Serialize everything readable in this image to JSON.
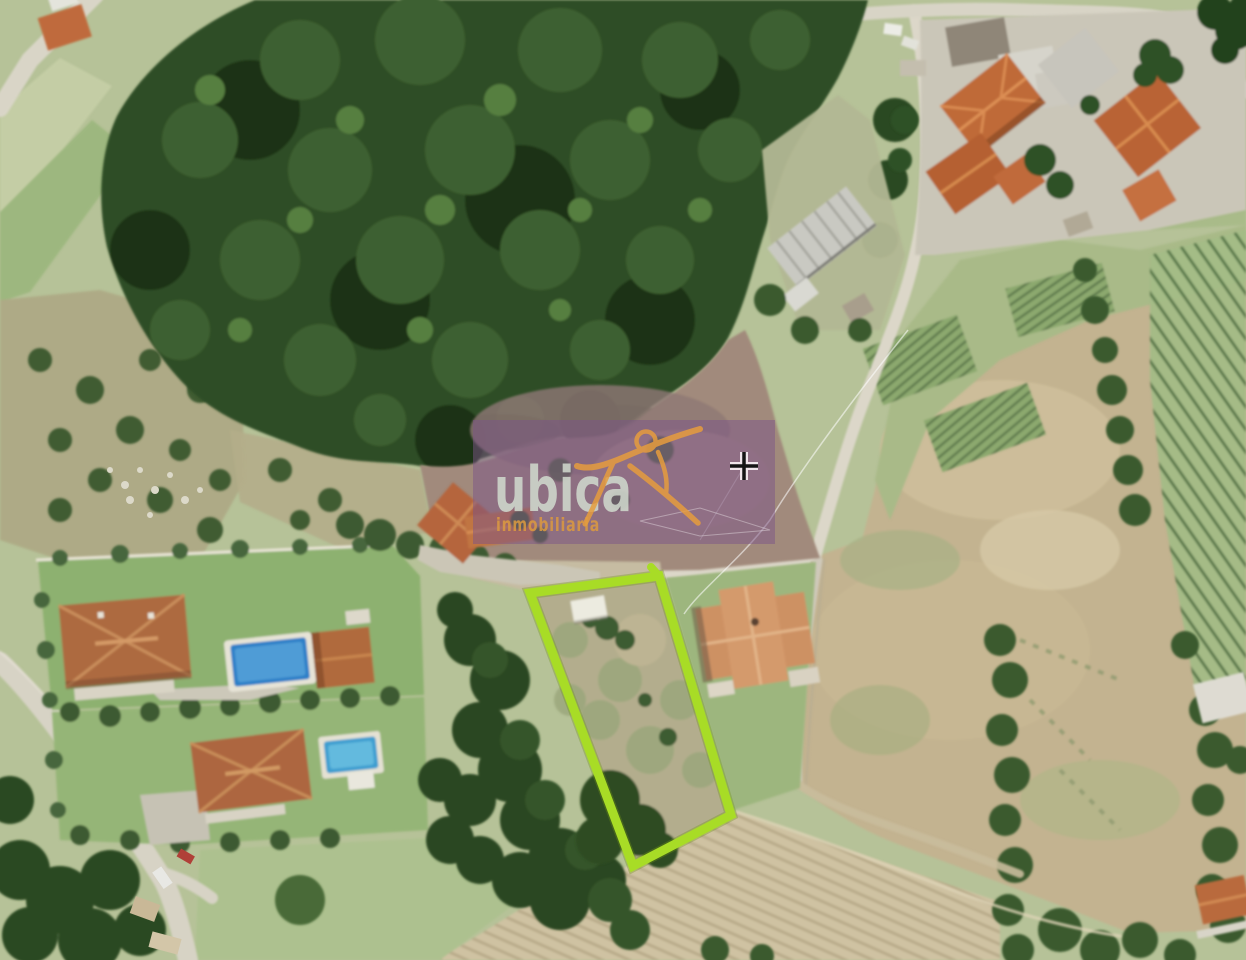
{
  "map": {
    "kind": "aerial-photo",
    "description_label": "satellite view with highlighted parcel"
  },
  "watermark": {
    "brand": "ubica",
    "subtitle": "inmobiliaria",
    "panel_color": "#7b5488",
    "brand_color": "#cfd8cc",
    "subtitle_color": "#dc9a40",
    "logo_color": "#e69d3e"
  },
  "parcel": {
    "outline_color": "#a8dc26"
  },
  "cursor": {
    "icon": "crosshair"
  }
}
